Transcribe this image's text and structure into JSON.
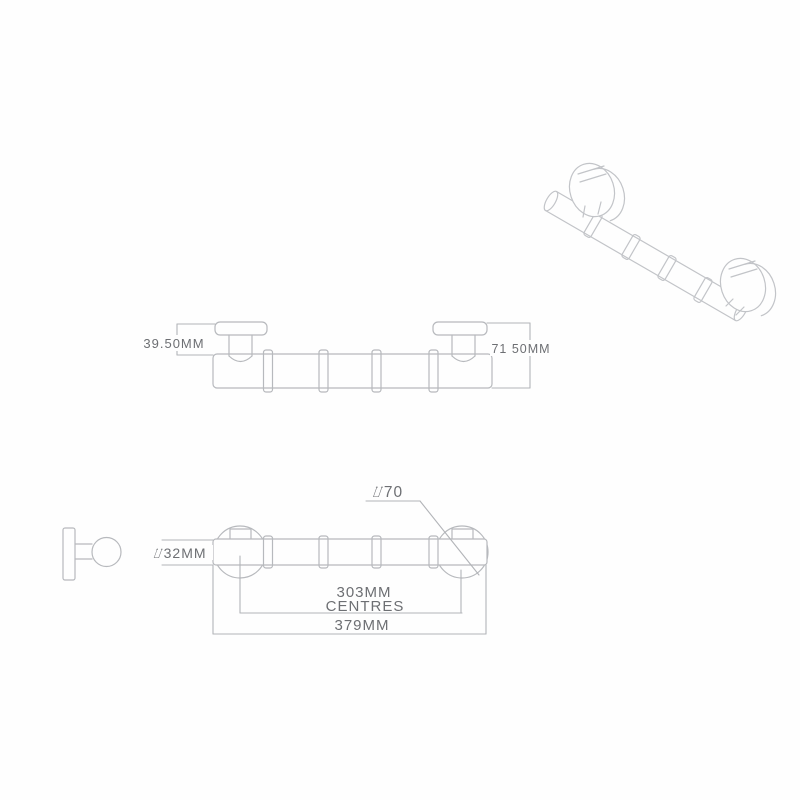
{
  "canvas": {
    "background": "#fefefe",
    "line_color": "#b7b9bd",
    "iso_line_color": "#c2c4c8",
    "text_color": "#6d6f73"
  },
  "labels": {
    "side_flange_height": "39.50MM",
    "side_overall_height": "71 50MM",
    "flange_diameter": "⌰70",
    "bar_diameter": "⌰32MM",
    "centres_value": "303MM",
    "centres_word": "CENTRES",
    "overall_length": "379MM"
  }
}
